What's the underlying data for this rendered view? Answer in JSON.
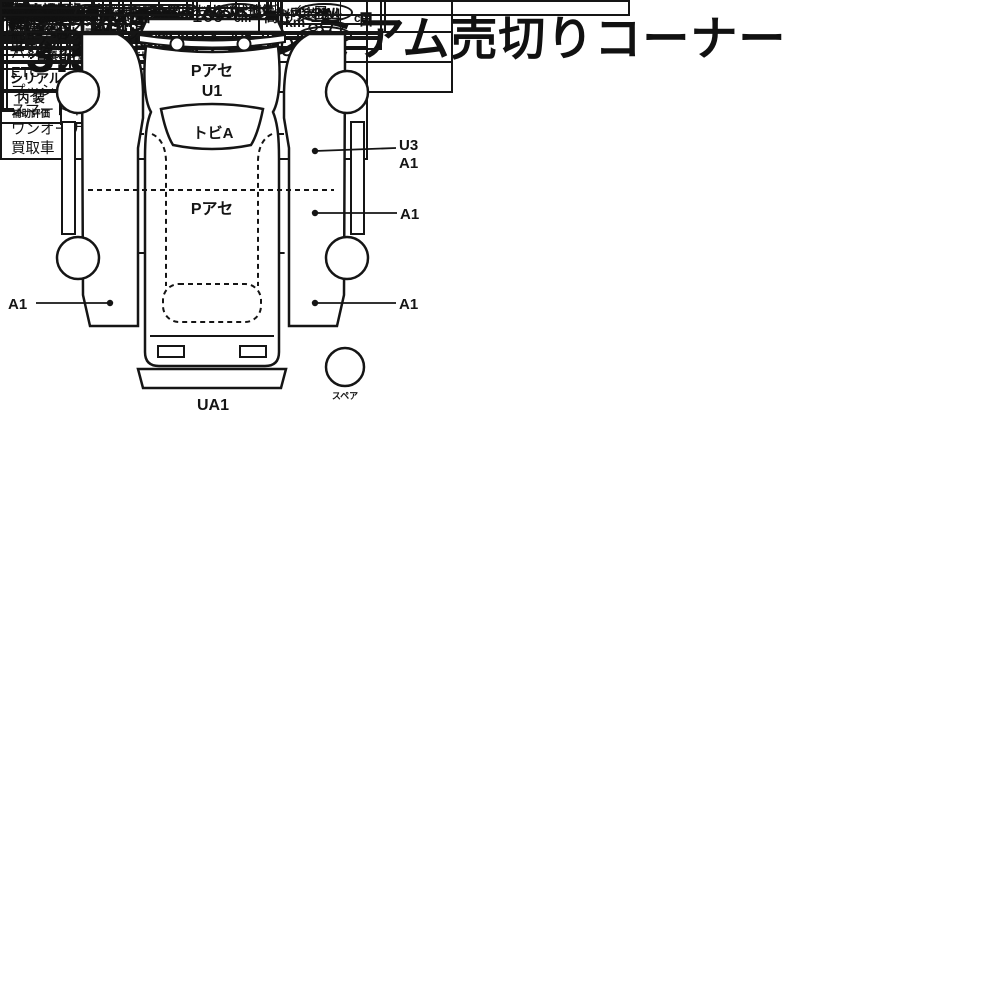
{
  "title": "プレミアム売切りコーナー",
  "lot": {
    "no_label": "No.",
    "number": "10314"
  },
  "spec": {
    "history_label": "車歴",
    "history_note": "（自家用以外は記入）",
    "displacement_label": "排気量",
    "displacement": "1500",
    "model_label": "型　式",
    "model": "DAA-NHP10",
    "first_reg_label": "初度登録年月",
    "first_reg_year": "H24",
    "first_reg_month": "11",
    "month_suffix": "月",
    "name_label": "車　名",
    "maker": "トヨタ",
    "name": "アクア",
    "shape_label": "形状･ドア数",
    "shape": "5D",
    "grade_label": "グレード",
    "grade": "G",
    "drive_label": "駆動",
    "drive": "2WD"
  },
  "score": {
    "label": "評価点",
    "value": "3.5",
    "interior_label_top": "内 装",
    "interior_label_bottom": "補助評価",
    "interior": "C"
  },
  "left": {
    "shaken_label": "車 検",
    "year": "年",
    "month": "月",
    "day": "日",
    "mileage_label": "走 行",
    "mileage": "198,800",
    "mileage_unit": "km",
    "ext_color_label": "外色",
    "orig_color_label": "元色",
    "orig_color": "ブルー",
    "color_change_label": "色替",
    "color_change": "→",
    "color_no_label": "カ ラ ー No.",
    "color_no": "8V7",
    "fuel_label": "燃料",
    "fuel": "ガソリン",
    "interior_color_label": "内 装 色",
    "import_label": "輸入車用",
    "year_model_label": "年式",
    "import_class_label": "輸 入 区 分",
    "handle_label": "ハ ン ド ル",
    "recycle_label1": "リサイクル",
    "recycle_label2": "預託金",
    "recycle_value": "9,980",
    "yen": "円",
    "capacity_label": "乗車定員",
    "capacity": "5",
    "capacity_unit": "人",
    "load_label": "積載量",
    "load_unit": "t",
    "caution_label": "◎注意事項",
    "caution_note": "（修復・不具合箇所および状態等）"
  },
  "mid": {
    "shift_label": "シフト",
    "shift": "FAT",
    "ac_label": "冷　房",
    "ac": "AAC",
    "book_label1": "新車整備手帳",
    "book_label2": "（保証書付）",
    "book_value": "有",
    "keep_note": "※書類と一緒に保管下さい。",
    "transfer_label": "譲渡書類有効期限",
    "transfer_month": "月",
    "transfer_day": "日"
  },
  "oem": {
    "label": "純正品",
    "row1": [
      {
        "t": "SR",
        "c": false
      },
      {
        "t": "純AW",
        "c": false
      },
      {
        "t": "PS",
        "c": true
      },
      {
        "t": "PW",
        "c": true
      }
    ],
    "row2": [
      {
        "t": "カワ",
        "c": false
      },
      {
        "t": "TV",
        "c": true
      },
      {
        "t": "ナビ",
        "c": true
      },
      {
        "t": "エアB",
        "c": true
      }
    ]
  },
  "sales": {
    "title": "セールスポイント",
    "items": [
      "純正ナビ・フルセグ",
      "バックカメラ",
      "ETC",
      "プッシュスタート",
      "スマートキー2個",
      "ワンオーナー",
      "買取車"
    ]
  },
  "registration": {
    "reg_label": "登　録",
    "chassis_label": "車　台",
    "serial_label": "シリアル",
    "no": "No.",
    "chassis": "NHP10-2123809"
  },
  "report": {
    "docs_line": "取説・保証書・ナビ取説・スペアキー　後日",
    "title": "◎検査員報告",
    "findings": [
      "ルーム内汚れ，キズ",
      "ハンドルハゲ",
      "ボディ色あせ",
      "ドアミラーキズ",
      "各キズ凹"
    ]
  },
  "diagram": {
    "front": "A1",
    "hood1": "Pアセ",
    "hood2": "U1",
    "windshield": "トビA",
    "roof": "Pアセ",
    "right_upper1": "U3",
    "right_upper2": "A1",
    "right_mid": "A1",
    "left_lower": "A1",
    "right_lower": "A1",
    "rear": "UA1",
    "spare": "スペア"
  },
  "cargo": {
    "header": "【荷台内寸】約",
    "times": "×",
    "unit_note": "(cm)",
    "length_label": "長さ",
    "length": "399",
    "width_label": "幅",
    "width": "169",
    "height_label": "高さ",
    "height": "144",
    "cm_unit": "cm",
    "choice_label": "第1希望：",
    "choice_value": "プレミアム売切り"
  }
}
